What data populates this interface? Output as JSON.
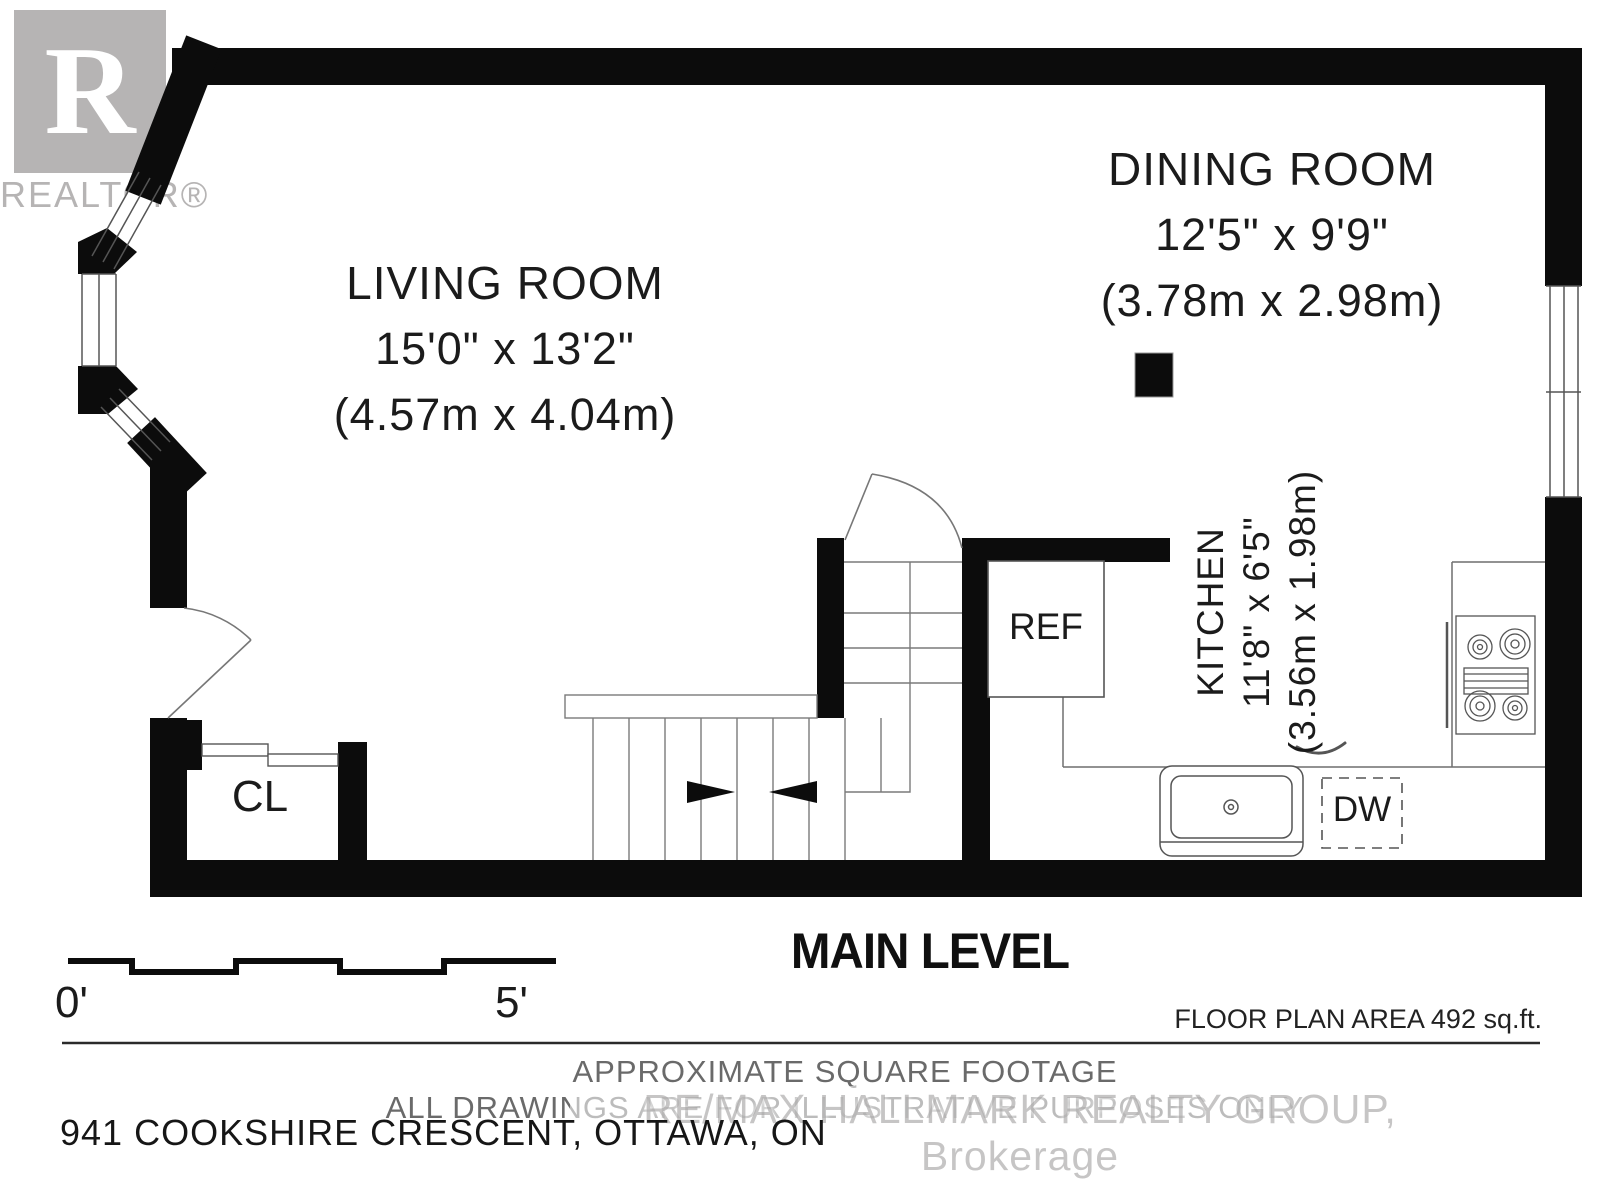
{
  "branding": {
    "logo_letter": "R",
    "logo_wordmark": "REALTOR®",
    "watermark": "RE/MAX HALLMARK REALTY GROUP, Brokerage"
  },
  "rooms": {
    "living_room": {
      "name": "LIVING ROOM",
      "size_imperial": "15'0\" x 13'2\"",
      "size_metric": "(4.57m x 4.04m)"
    },
    "dining_room": {
      "name": "DINING ROOM",
      "size_imperial": "12'5\" x 9'9\"",
      "size_metric": "(3.78m x 2.98m)"
    },
    "kitchen": {
      "name": "KITCHEN",
      "size_imperial": "11'8\" x 6'5\"",
      "size_metric": "(3.56m x 1.98m)"
    },
    "closet": {
      "abbr": "CL"
    }
  },
  "fixtures": {
    "refrigerator_label": "REF",
    "dishwasher_label": "DW"
  },
  "scale_bar": {
    "start_label": "0'",
    "end_label": "5'"
  },
  "footer": {
    "level_title": "MAIN LEVEL",
    "area_note": "FLOOR PLAN AREA 492 sq.ft.",
    "disclaimer_line1": "APPROXIMATE SQUARE FOOTAGE",
    "disclaimer_line2": "ALL DRAWINGS ARE FOR ILLUSTRATIVE PURPOSES ONLY",
    "address": "941 COOKSHIRE CRESCENT, OTTAWA, ON"
  },
  "colors": {
    "wall": "#0c0c0c",
    "thin_line": "#6f6f6f",
    "fixture_line": "#555555",
    "label_text": "#1b1b1b",
    "muted_text": "#6a6a6a",
    "logo_gray": "#b6b4b4",
    "watermark_gray": "#989595"
  }
}
